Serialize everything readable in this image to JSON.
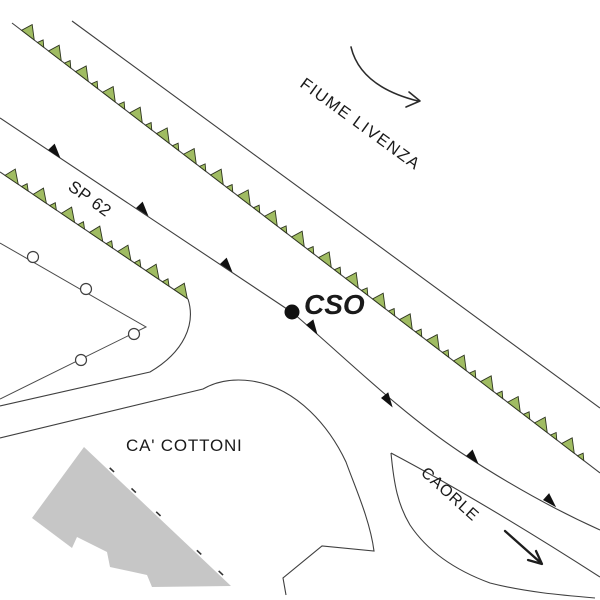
{
  "map": {
    "background": "#ffffff",
    "labels": {
      "fiume_livenza": {
        "text": "FIUME LIVENZA",
        "transform": "translate(299,86) rotate(36)"
      },
      "sp62": {
        "text": "SP 62",
        "transform": "translate(67,189) rotate(36)"
      },
      "ca_cottoni": {
        "text": "CA' COTTONI",
        "transform": "translate(126,451)"
      },
      "caorle": {
        "text": "CAORLE",
        "transform": "translate(420,474) rotate(42)"
      },
      "station": {
        "text": "CSO",
        "transform": "translate(304,314)"
      }
    },
    "station_marker": {
      "code": "CSO",
      "x": 292,
      "y": 312,
      "r": 7.5,
      "color": "#111111"
    },
    "colors": {
      "line": "#3f3f3f",
      "levee_fill": "#a0bc62",
      "levee_stroke": "#2e351f",
      "road_marker": "#111111",
      "building_fill": "#c6c6c6",
      "tick": "#333333",
      "circle_fill": "#ffffff"
    },
    "symbols": {
      "levees": [
        {
          "id": "levee-river",
          "x1": 12,
          "y1": 23,
          "x2": 600,
          "y2": 473,
          "offset": 12,
          "period": 34
        },
        {
          "id": "levee-sp62",
          "x1": 0,
          "y1": 172,
          "x2": 188,
          "y2": 299,
          "offset": 6,
          "period": 34
        }
      ],
      "road_markers": {
        "points_x": [
          48,
          136,
          220,
          306,
          381,
          466,
          543
        ],
        "points_y": [
          150,
          208,
          264,
          325,
          398,
          456,
          500
        ],
        "angles": [
          33.6,
          33.6,
          33.6,
          40,
          39,
          33,
          29
        ]
      },
      "utility_circles": {
        "r": 5.5,
        "centers": [
          [
            33,
            257
          ],
          [
            86,
            289
          ],
          [
            134,
            334
          ],
          [
            81,
            360
          ]
        ]
      },
      "building_ticks": {
        "x1": 84,
        "y1": 447,
        "x2": 231,
        "y2": 586,
        "dists": [
          36,
          66,
          100,
          156,
          186
        ]
      }
    }
  }
}
